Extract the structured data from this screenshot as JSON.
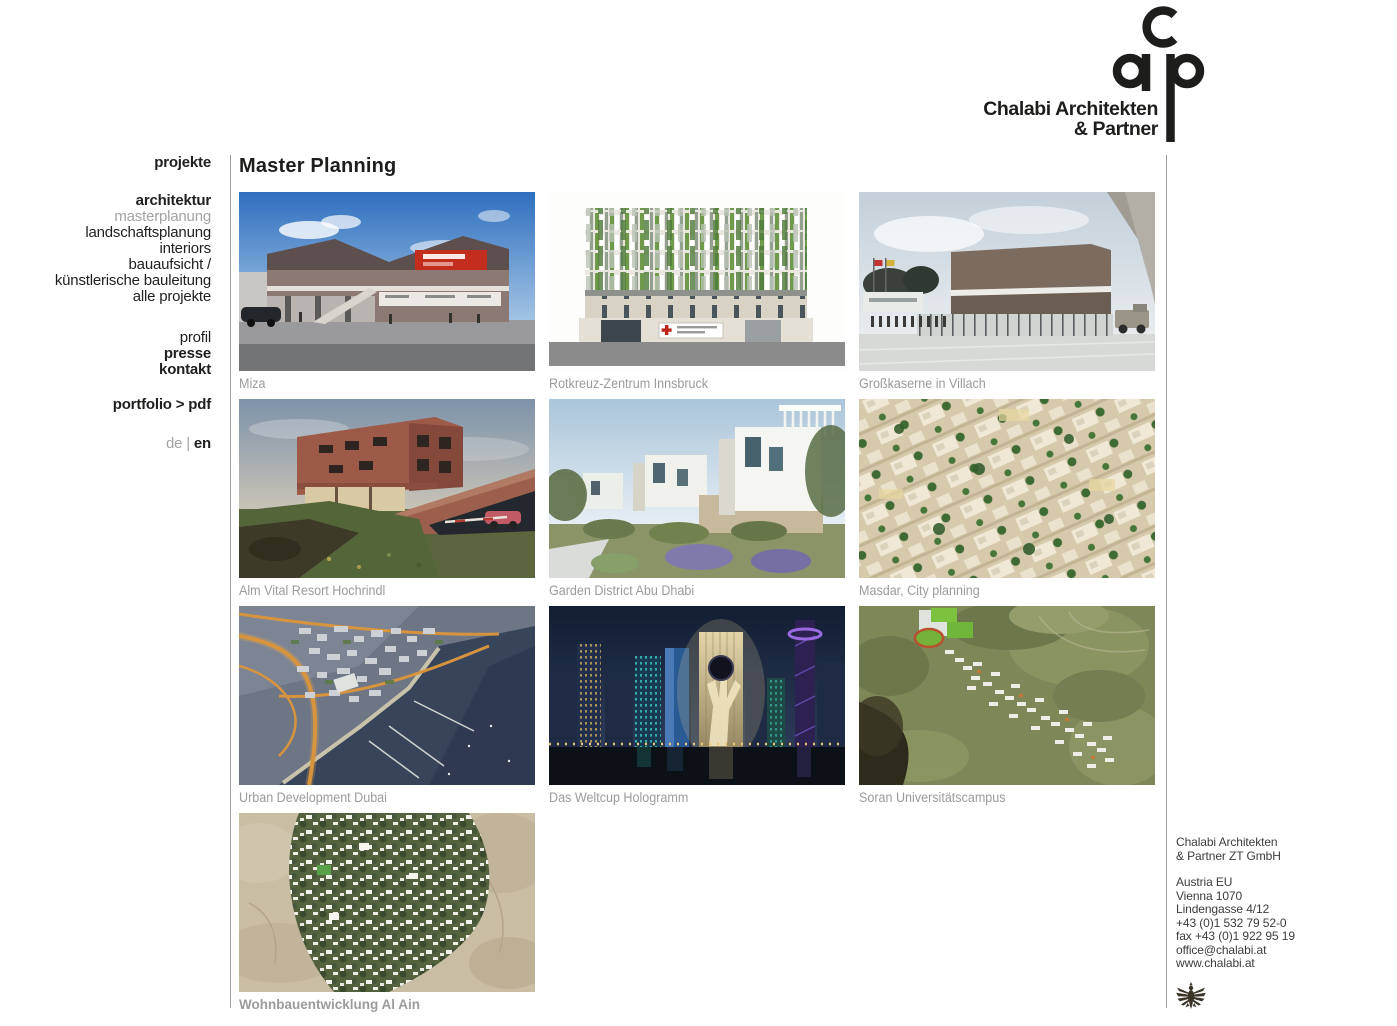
{
  "brand": {
    "name_line1": "Chalabi Architekten",
    "name_line2": "& Partner",
    "monogram": "cap"
  },
  "sidebar": {
    "projekte": "projekte",
    "architektur": "architektur",
    "masterplanung": "masterplanung",
    "landschaftsplanung": "landschaftsplanung",
    "interiors": "interiors",
    "bauaufsicht": "bauaufsicht /",
    "kuenstlerische": "künstlerische bauleitung",
    "alle_projekte": "alle projekte",
    "profil": "profil",
    "presse": "presse",
    "kontakt": "kontakt",
    "portfolio_label": "portfolio",
    "portfolio_sep": ">",
    "portfolio_target": "pdf",
    "lang_de": "de",
    "lang_sep": "|",
    "lang_en": "en"
  },
  "main": {
    "title": "Master Planning",
    "projects": [
      {
        "title": "Miza"
      },
      {
        "title": "Rotkreuz-Zentrum Innsbruck"
      },
      {
        "title": "Großkaserne in Villach"
      },
      {
        "title": "Alm Vital Resort Hochrindl"
      },
      {
        "title": "Garden District Abu Dhabi"
      },
      {
        "title": "Masdar, City planning"
      },
      {
        "title": "Urban Development Dubai"
      },
      {
        "title": "Das Weltcup Hologramm"
      },
      {
        "title": "Soran Universitätscampus"
      },
      {
        "title": "Wohnbauentwicklung Al Ain"
      }
    ]
  },
  "contact": {
    "company_line1": "Chalabi Architekten",
    "company_line2": "& Partner ZT GmbH",
    "address_line1": "Austria EU",
    "address_line2": "Vienna 1070",
    "address_line3": "Lindengasse 4/12",
    "phone": "+43 (0)1 532 79 52-0",
    "fax": "fax +43 (0)1 922 95 19",
    "email": "office@chalabi.at",
    "website": "www.chalabi.at"
  },
  "icons": {
    "logo": "cap-monogram",
    "eagle": "austrian-federal-eagle"
  },
  "colors": {
    "text": "#1f1f1d",
    "muted": "#a3a3a3",
    "caption": "#9b9b9b",
    "divider": "#9c9c9c",
    "logo": "#1d1d1b"
  }
}
